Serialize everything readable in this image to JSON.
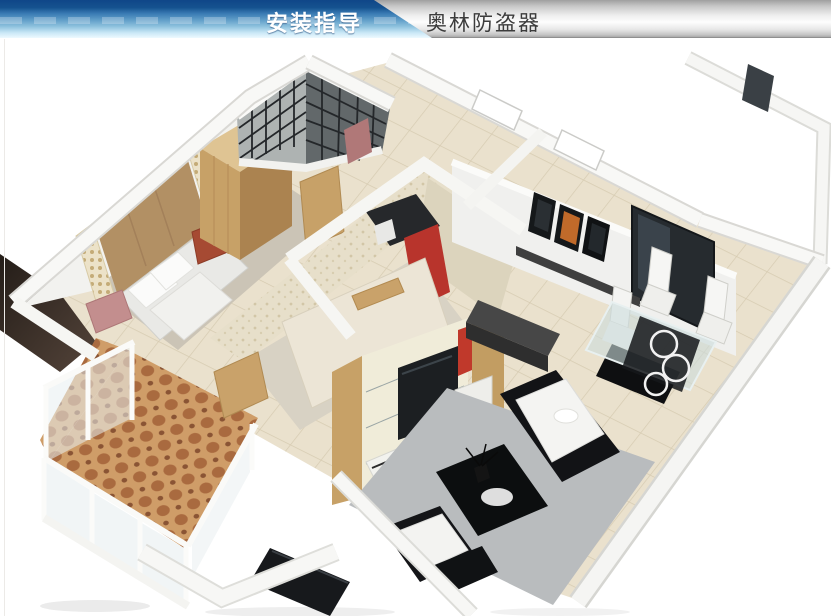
{
  "header": {
    "tab_label": "安装指导",
    "brand_label": "奥林防盗器"
  },
  "theme": {
    "header_blue_dark": "#0f4688",
    "header_blue_light": "#c9e7f6",
    "header_gray": "#c6c6c6",
    "header_text_light": "#ffffff",
    "header_text_dark": "#3c3c3c",
    "page_bg": "#ffffff"
  },
  "figure": {
    "description": "3D isometric cutaway floor plan render of an apartment: master bedroom with tan headboard wall, white bed, red nightstand and wood wardrobe; dark lattice-walled bathroom; second bedroom with textured walls, cream bed and red-black shelf unit backing a wood TV wall; living room with gray rug, black-and-white sofas and black coffee table; dining corner with glass table, white chairs and wine-rack cabinet; dark-framed balcony door and picture frames on the rear wall; balcony with terracotta mosaic tile floor and white-framed glazing",
    "palette": {
      "wall_white": "#f5f5f3",
      "wood_tan": "#c7a167",
      "floor_beige": "#eae1cd",
      "mosaic_terracotta": "#cf9d68",
      "accent_red": "#b04434",
      "accent_pink": "#c38e8e",
      "furniture_black": "#17191c",
      "rug_gray": "#b9bcbe"
    }
  }
}
